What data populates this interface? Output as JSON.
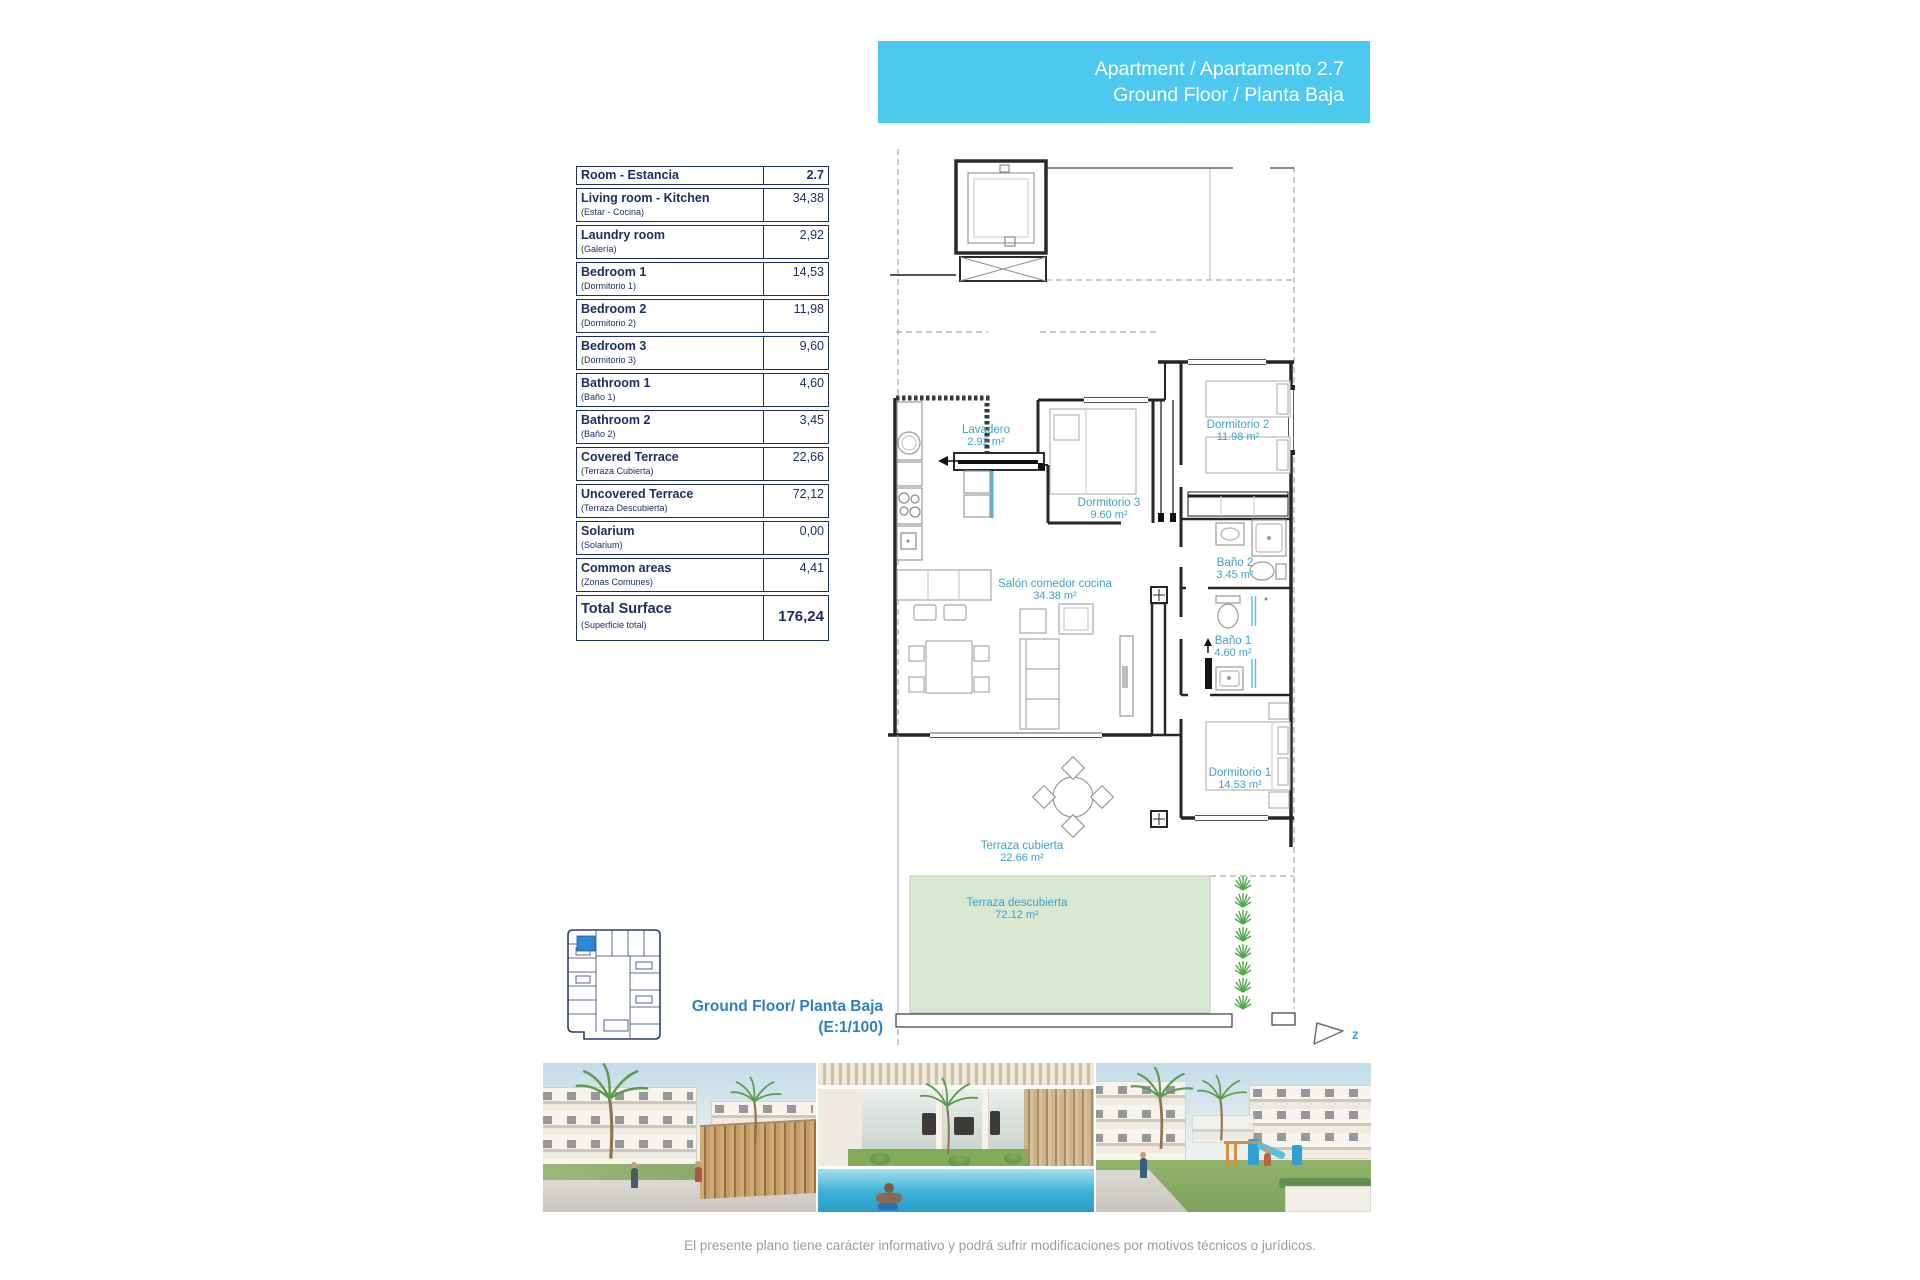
{
  "banner": {
    "line1": "Apartment / Apartamento 2.7",
    "line2": "Ground Floor / Planta Baja"
  },
  "room_table": {
    "header": {
      "label": "Room - Estancia",
      "value": "2.7"
    },
    "rows": [
      {
        "name": "Living room - Kitchen",
        "subname": "(Estar - Cocina)",
        "value": "34,38"
      },
      {
        "name": "Laundry room",
        "subname": "(Galería)",
        "value": "2,92"
      },
      {
        "name": "Bedroom 1",
        "subname": "(Dormitorio 1)",
        "value": "14,53"
      },
      {
        "name": "Bedroom 2",
        "subname": "(Dormitorio 2)",
        "value": "11,98"
      },
      {
        "name": "Bedroom 3",
        "subname": "(Dormitorio 3)",
        "value": "9,60"
      },
      {
        "name": "Bathroom 1",
        "subname": "(Baño 1)",
        "value": "4,60"
      },
      {
        "name": "Bathroom 2",
        "subname": "(Baño 2)",
        "value": "3,45"
      },
      {
        "name": "Covered Terrace",
        "subname": "(Terraza Cubierta)",
        "value": "22,66"
      },
      {
        "name": "Uncovered Terrace",
        "subname": "(Terraza Descubierta)",
        "value": "72,12"
      },
      {
        "name": "Solarium",
        "subname": "(Solarium)",
        "value": "0,00"
      },
      {
        "name": "Common areas",
        "subname": "(Zonas Comunes)",
        "value": "4,41"
      }
    ],
    "total": {
      "name": "Total Surface",
      "subname": "(Superficie total)",
      "value": "176,24"
    }
  },
  "plan": {
    "rooms": [
      {
        "name": "Lavadero",
        "area": "2.92 m²"
      },
      {
        "name": "Dormitorio 3",
        "area": "9.60 m²"
      },
      {
        "name": "Dormitorio 2",
        "area": "11.98 m²"
      },
      {
        "name": "Baño 2",
        "area": "3.45 m²"
      },
      {
        "name": "Baño 1",
        "area": "4.60 m²"
      },
      {
        "name": "Dormitorio 1",
        "area": "14.53 m²"
      },
      {
        "name": "Salón comedor cocina",
        "area": "34.38 m²"
      },
      {
        "name": "Terraza cubierta",
        "area": "22.66 m²"
      },
      {
        "name": "Terraza descubierta",
        "area": "72.12 m²"
      }
    ],
    "north_label": "z"
  },
  "key_caption": {
    "line1": "Ground Floor/ Planta Baja",
    "line2": "(E:1/100)"
  },
  "footer": {
    "disclaimer": "El presente plano tiene carácter informativo y podrá sufrir modificaciones por motivos técnicos o jurídicos."
  },
  "colors": {
    "banner_bg": "#4DC8EF",
    "plan_label_blue": "#3FA0C4",
    "caption_blue": "#2D7FC6",
    "table_navy": "#1C2E63",
    "terrace_green": "#D9E8D0",
    "key_unit_highlight": "#2E86D6"
  }
}
